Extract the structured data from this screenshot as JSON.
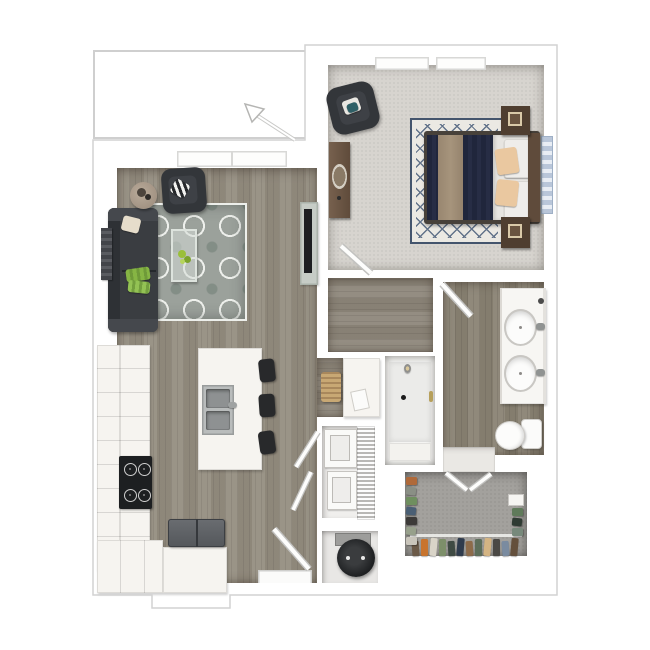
{
  "scene": {
    "type": "3d-floorplan-top-view-render",
    "layout": "one-bedroom-one-bath-apartment",
    "background": "#ffffff"
  },
  "colors": {
    "shadow": "#dadada",
    "outline": "#d2d2d2",
    "wood": "#948d80",
    "wood-hall": "#8d867a",
    "wood-bath": "#8a8374",
    "carpet-bed": "#d7d4cf",
    "carpet-closet": "#a3a19d",
    "rug-base": "#9ba19b",
    "rug-bed-base": "#ebe9e3",
    "rug-bed-lattice": "#62738a",
    "rug-bed-border": "#44556d",
    "sofa": "#3a3d41",
    "charcoal": "#33363a",
    "wood-furn": "#5f4b3b",
    "wood-furn-dark": "#4f3e30",
    "navy": "#20263c",
    "runner": "#a6947c",
    "sheet": "#e7e5e1",
    "peach": "#eac8a0",
    "counter": "#f6f4f0",
    "steel": "#b9bcbc",
    "black": "#1d1f21",
    "fridge": "#54575b",
    "green": "#86b544",
    "tile": "#eae8e4",
    "heater": "#1d1f21",
    "win-blue": "#b9c6d9",
    "glass": "#c6ccc6"
  },
  "rooms": [
    {
      "id": "patio",
      "floor": "outside"
    },
    {
      "id": "living-room",
      "floor": "wood-plank"
    },
    {
      "id": "kitchen",
      "floor": "wood-plank"
    },
    {
      "id": "entry",
      "floor": "wood-plank"
    },
    {
      "id": "bedroom",
      "floor": "carpet"
    },
    {
      "id": "bedroom-hall-closet",
      "floor": "wood-plank"
    },
    {
      "id": "bathroom",
      "floor": "wood-plank"
    },
    {
      "id": "pantry-closet",
      "floor": "wood-plank"
    },
    {
      "id": "shower-stall",
      "floor": "tile"
    },
    {
      "id": "laundry-closet",
      "floor": "tile"
    },
    {
      "id": "utility-closet",
      "floor": "tile"
    },
    {
      "id": "walk-in-closet",
      "floor": "carpet"
    }
  ],
  "furniture": {
    "living_room": [
      "sofa",
      "accent-chair",
      "side-table",
      "trellis-area-rug",
      "glass-coffee-table",
      "wall-art",
      "tv-console",
      "window"
    ],
    "kitchen": [
      "l-shaped-counter",
      "cooktop",
      "refrigerator",
      "peninsula-cabinet",
      "island-with-double-sink",
      "bar-stool",
      "bar-stool",
      "bar-stool"
    ],
    "bedroom": [
      "bed",
      "headboard",
      "nightstand",
      "nightstand",
      "accent-chair",
      "dresser-with-mirror",
      "lattice-area-rug",
      "window",
      "window",
      "side-window"
    ],
    "bathroom": [
      "double-sink-vanity",
      "toilet",
      "shower-head",
      "door"
    ],
    "laundry_closet": [
      "stacked-washer",
      "stacked-dryer",
      "wire-shelving"
    ],
    "utility_closet": [
      "water-heater"
    ],
    "walk_in_closet": [
      "hanging-clothes",
      "shelf-box"
    ],
    "pantry_closet": [
      "wicker-basket",
      "shelving-cabinet"
    ]
  },
  "closet_clothes": {
    "left_items": [
      "#b06a3a",
      "#8a8f85",
      "#6f8f5f",
      "#4a5f74",
      "#3c3a38",
      "#97a08b",
      "#c9c5bb"
    ],
    "bottom_items": [
      "#6b5a48",
      "#c8742e",
      "#d9d4c8",
      "#7d8f6a",
      "#3f4a43",
      "#2f3b4d",
      "#8d6b4a",
      "#5d6e5a",
      "#d4b483",
      "#4a4845",
      "#7a8ba0",
      "#64503c"
    ],
    "right_items": [
      "#5f7a5a",
      "#2f3b33",
      "#77897b"
    ]
  },
  "doors": [
    "entry-door",
    "bedroom-door",
    "bathroom-door",
    "closet-double-door",
    "laundry-bifold-door",
    "laundry-bifold-door"
  ],
  "annotations": [
    "entry-direction-arrow"
  ]
}
